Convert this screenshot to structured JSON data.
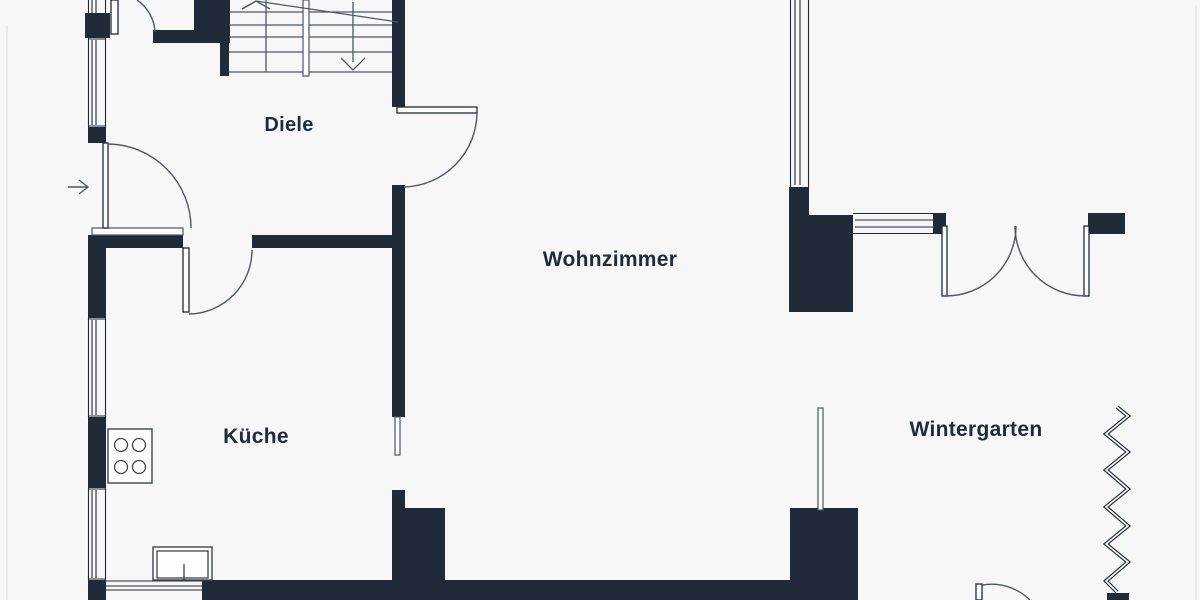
{
  "plan": {
    "colors": {
      "background": "#f7f7f7",
      "wall": "#202a39",
      "line": "#4d5765",
      "fixture": "#3c4553",
      "label": "#202c3c",
      "edge": "#e6e7e9"
    },
    "rooms": [
      {
        "id": "diele",
        "label": "Diele"
      },
      {
        "id": "wohnzimmer",
        "label": "Wohnzimmer"
      },
      {
        "id": "kueche",
        "label": "Küche"
      },
      {
        "id": "wintergarten",
        "label": "Wintergarten"
      }
    ],
    "icons": {
      "entrance_arrow": "arrow-right-entrance",
      "stairs_down_arrow": "arrow-down-stairs",
      "stairs_up_arrow": "arrow-up-stairs",
      "stove": "cooktop-4-burners",
      "sink": "kitchen-sink",
      "break_line": "zigzag-break-line"
    }
  }
}
